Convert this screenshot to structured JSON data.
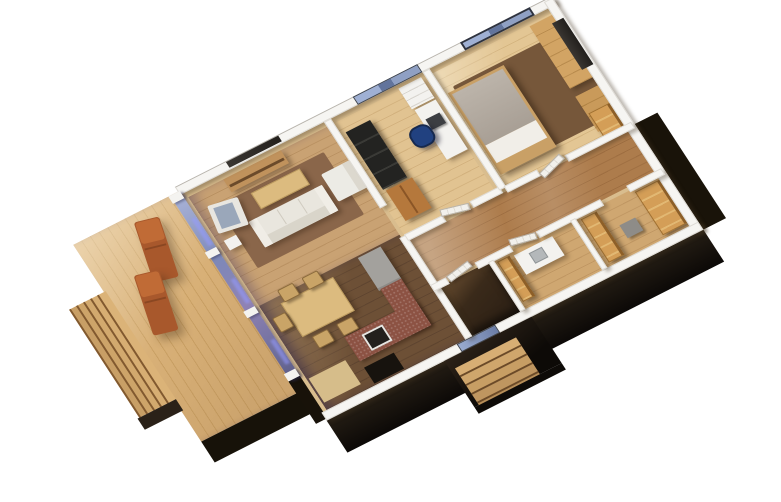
{
  "scene": {
    "type": "3d-floor-plan-render",
    "style": "isometric dollhouse cutaway, roof removed, viewed from above",
    "background": "#ffffff",
    "building": "single-storey house with black exterior cladding, wooden deck terrace and outdoor entry steps"
  },
  "palette": {
    "deck_wood": "#d8b077",
    "interior_wood_light": "#e3c694",
    "interior_wood_mid": "#c9a273",
    "floor_dark_brown": "#6d5036",
    "hall_gloss_wood": "#ad7c4c",
    "rug_brown": "#8a664a",
    "rug_dark": "#76573a",
    "wall_white": "#f6f5f2",
    "cladding_black": "#171209",
    "glass_blue": "#8ba0c8",
    "plywood_orange": "#d49e57",
    "counter_brick_red": "#8c5243",
    "sofa_cream": "#e9e6de",
    "daybed_black": "#232321",
    "office_chair_blue": "#214180",
    "lounger_terracotta": "#a8582c",
    "bed_blanket_grey": "#b2aaa0",
    "table_wood": "#dcbb7f"
  },
  "exterior": {
    "deck_steps_count": 5,
    "entry_steps_count": 5,
    "sun_loungers_count": 2,
    "glass_wall_posts_count": 4,
    "facade_windows_count": 2
  },
  "rooms": [
    {
      "id": "deck",
      "name": "Deck terrace",
      "features": [
        "plank decking",
        "5 wide steps",
        "2 terracotta sun loungers",
        "full-height glass wall to house"
      ]
    },
    {
      "id": "living",
      "name": "Living room",
      "features": [
        "cream 3-seat sofa",
        "white armchair",
        "grey armchair",
        "wood coffee table",
        "wood TV sideboard",
        "wall-mounted TV",
        "brown rug"
      ]
    },
    {
      "id": "dining",
      "name": "Dining area",
      "features": [
        "light wood table",
        "5 wood chairs",
        "dark wood floor",
        "tan doormat"
      ]
    },
    {
      "id": "kitchen",
      "name": "Kitchen",
      "features": [
        "brick-red counters",
        "black cooktop",
        "grey appliance block"
      ]
    },
    {
      "id": "office",
      "name": "Study",
      "features": [
        "black daybed",
        "wood wardrobe",
        "white shelving unit",
        "white desk with monitor",
        "blue task chair"
      ]
    },
    {
      "id": "bedroom",
      "name": "Bedroom",
      "features": [
        "double bed with grey blanket",
        "long wood dressers",
        "wall-mounted TV",
        "dark rug",
        "plywood closet",
        "picture window"
      ]
    },
    {
      "id": "hallway",
      "name": "Hallway",
      "features": [
        "glossy wood floor",
        "white panel doors"
      ]
    },
    {
      "id": "vestibule",
      "name": "Entry vestibule",
      "features": [
        "dark glossy floor",
        "glass entry door",
        "outdoor porch with wood steps"
      ]
    },
    {
      "id": "bathroom",
      "name": "Bathroom",
      "features": [
        "white vanity with sink",
        "plywood cabinet"
      ]
    },
    {
      "id": "walkin",
      "name": "Walk-in closet",
      "features": [
        "plywood shelving units",
        "grey hamper"
      ]
    }
  ]
}
